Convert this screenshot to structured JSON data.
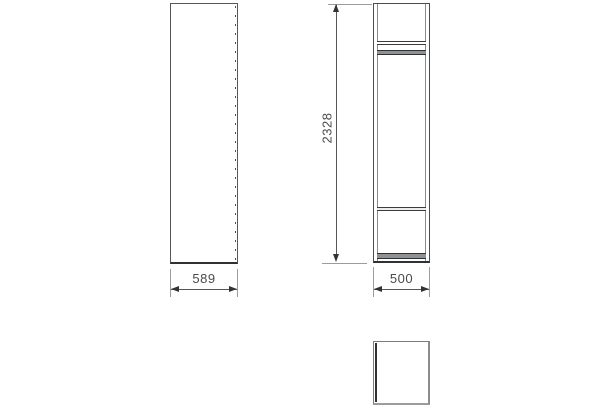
{
  "drawing": {
    "dimension_labels": {
      "width": "589",
      "depth": "500",
      "height": "2328"
    },
    "colors": {
      "background": "#ffffff",
      "cabinet_outline": "#4a4d4f",
      "cabinet_outline_dark": "#2f3234",
      "panel_fill": "#8f9294",
      "extension_line": "#9a9da0",
      "dimension_line": "#55585a",
      "arrowhead": "#333333",
      "label_text": "#4a4a4a"
    }
  }
}
